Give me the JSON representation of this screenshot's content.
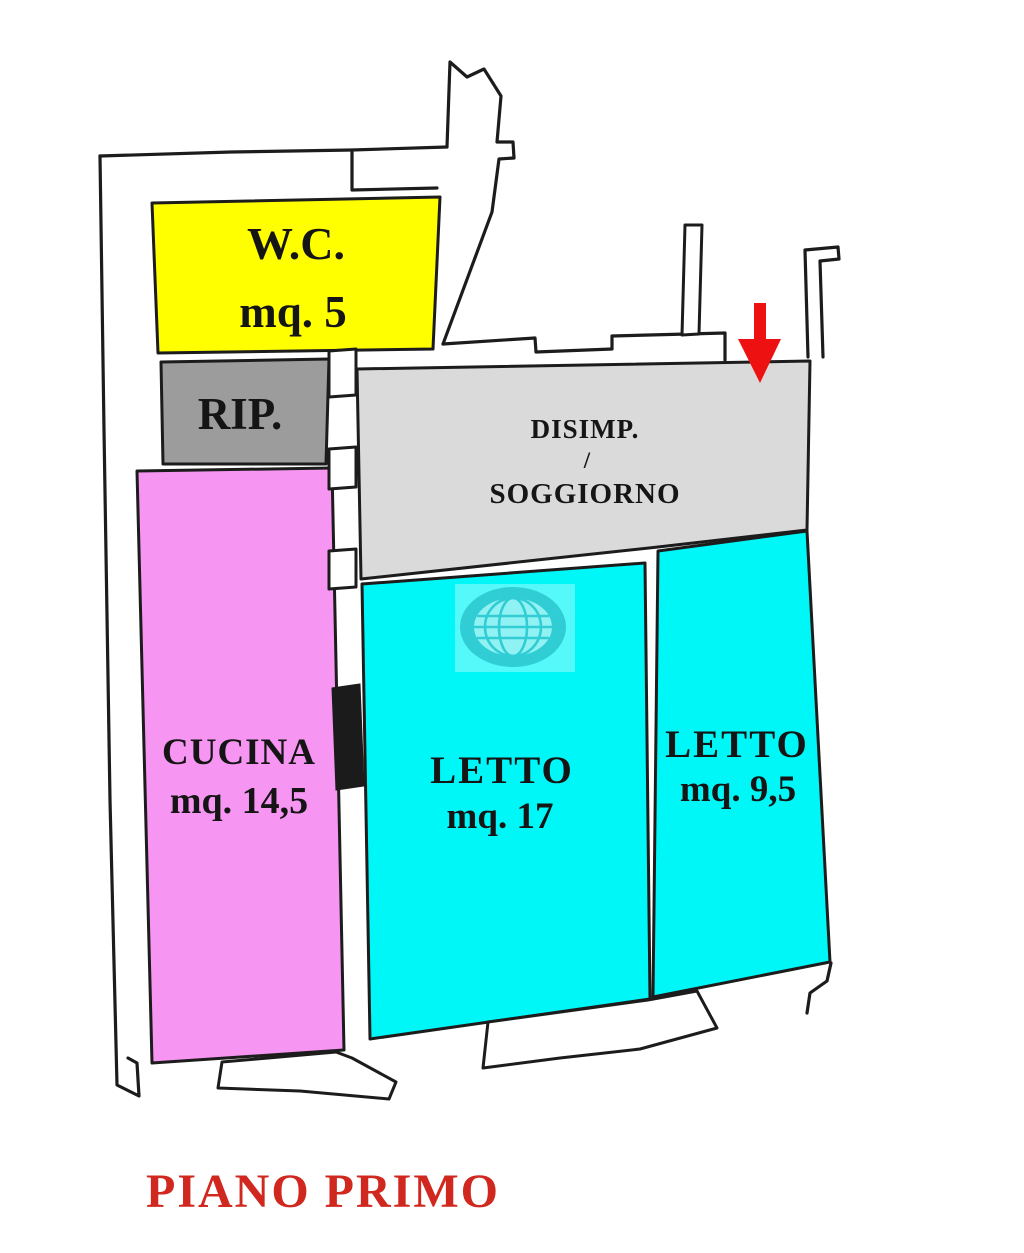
{
  "plan": {
    "title": {
      "text": "PIANO PRIMO",
      "color": "#d0281f"
    },
    "wall_color": "#1c1c1c",
    "arrow": {
      "meaning": "entrance-pointer",
      "color": "#ee1111"
    },
    "rooms": {
      "wc": {
        "label": "W.C.",
        "area": "mq. 5",
        "color": "#ffff00"
      },
      "rip": {
        "label": "RIP.",
        "color": "#9c9c9c"
      },
      "disimpegno_soggiorno": {
        "label": "DISIMP.",
        "separator": "/",
        "label2": "SOGGIORNO",
        "color": "#dadada"
      },
      "cucina": {
        "label": "CUCINA",
        "area": "mq. 14,5",
        "color": "#f795f2"
      },
      "letto_grande": {
        "label": "LETTO",
        "area": "mq. 17",
        "color": "#00f7f7"
      },
      "letto_piccolo": {
        "label": "LETTO",
        "area": "mq. 9,5",
        "color": "#00f7f7"
      }
    },
    "watermark": {
      "icon": "globe",
      "ring_color": "#3cc3cd"
    }
  }
}
